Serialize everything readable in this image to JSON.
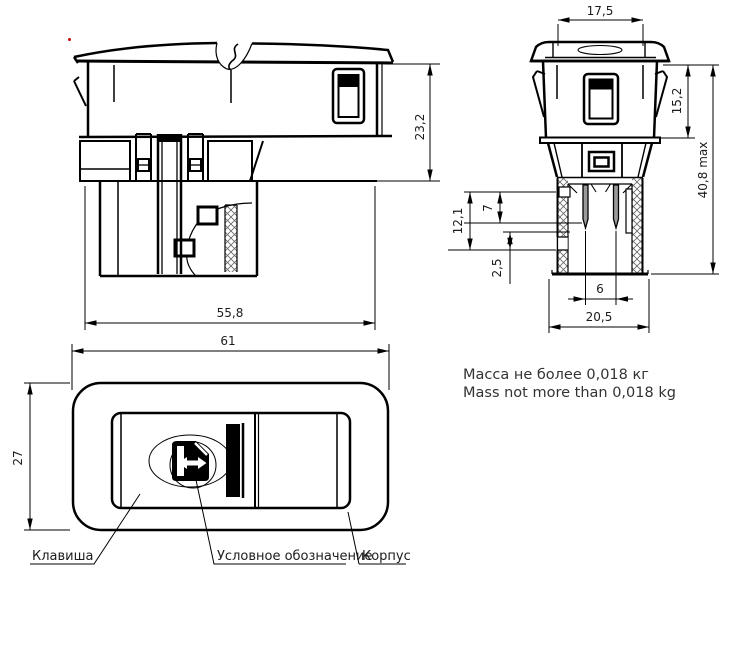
{
  "dimensions": {
    "side_height": "23,2",
    "side_width": "55,8",
    "front_top_width": "17,5",
    "front_upper_height": "15,2",
    "front_total_height": "40,8 max",
    "front_connector_depth": "12,1",
    "front_pin_length": "7",
    "front_chamfer": "2,5",
    "front_pin_pitch": "6",
    "front_connector_width": "20,5",
    "face_width": "61",
    "face_height": "27"
  },
  "callouts": {
    "key": "Клавиша",
    "symbol": "Условное обозначение",
    "housing": "Корпус"
  },
  "notes": {
    "mass_ru": "Масса не более 0,018 кг",
    "mass_en": "Mass not more than 0,018 kg"
  },
  "icon": {
    "symbol_icon": "power-window-icon"
  },
  "colors": {
    "line": "#000000",
    "dim_text": "#1c1c1c",
    "note_text": "#333333",
    "pin_fill": "#9a9a9a",
    "marker_dot": "#cc0000"
  }
}
